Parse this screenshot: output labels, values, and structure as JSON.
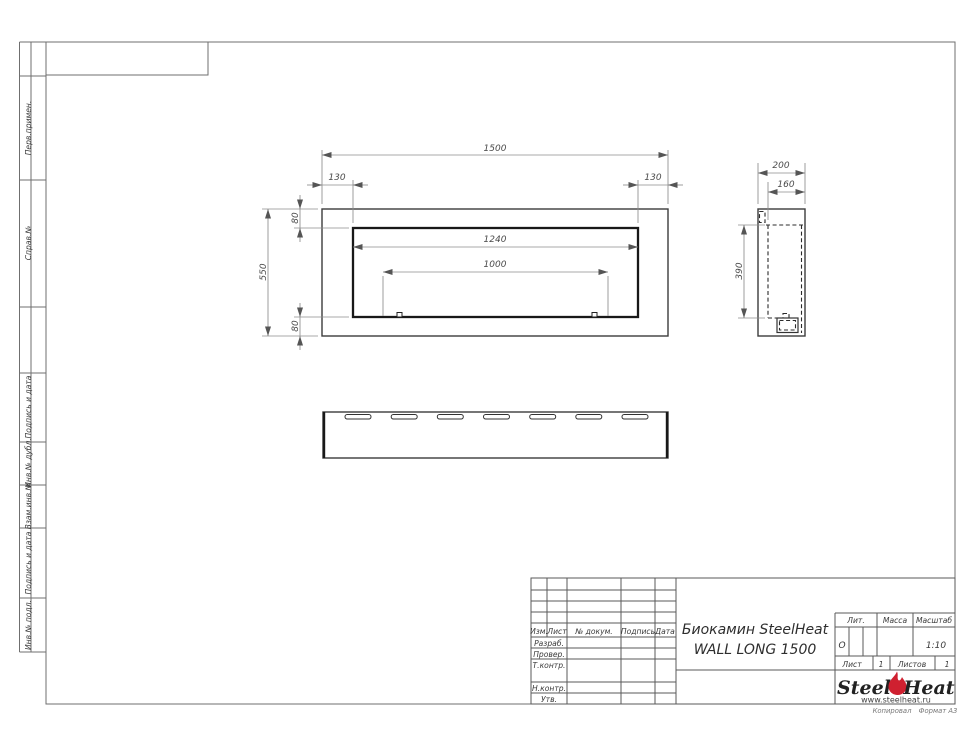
{
  "sheet": {
    "copy_note": "Копировал",
    "format_note": "Формат А3"
  },
  "sidebar": {
    "items": [
      {
        "label": "Перв.примен."
      },
      {
        "label": "Справ.№"
      },
      {
        "label": "Подпись и дата"
      },
      {
        "label": "Инв.№ дубл."
      },
      {
        "label": "Взам.инв.№"
      },
      {
        "label": "Подпись и дата"
      },
      {
        "label": "Инв.№ подл."
      }
    ]
  },
  "drawing": {
    "front_view": {
      "dim_overall_width": "1500",
      "dim_left_margin": "130",
      "dim_right_margin": "130",
      "dim_top_margin": "80",
      "dim_bottom_margin": "80",
      "dim_overall_height": "550",
      "dim_opening_width": "1240",
      "dim_burner_width": "1000"
    },
    "side_view": {
      "dim_depth": "200",
      "dim_inner_depth": "160",
      "dim_firebox_height": "390"
    },
    "bottom_view": {
      "slot_count": 7
    }
  },
  "title_block": {
    "revision_header": {
      "izm": "Изм.",
      "list": "Лист",
      "doc": "№ докум.",
      "podpis": "Подпись",
      "data": "Дата"
    },
    "roles": [
      "Разраб.",
      "Провер.",
      "Т.контр.",
      "Н.контр.",
      "Утв."
    ],
    "title_line1": "Биокамин SteelHeat",
    "title_line2": "WALL LONG 1500",
    "lit_label": "Лит.",
    "lit_value": "О",
    "mass_label": "Масса",
    "scale_label": "Масштаб",
    "scale_value": "1:10",
    "sheet_label": "Лист",
    "sheet_value": "1",
    "sheets_label": "Листов",
    "sheets_value": "1",
    "logo": {
      "word1": "Steel",
      "word2": "Heat",
      "website": "www.steelheat.ru",
      "flame_color": "#cf2030"
    }
  }
}
